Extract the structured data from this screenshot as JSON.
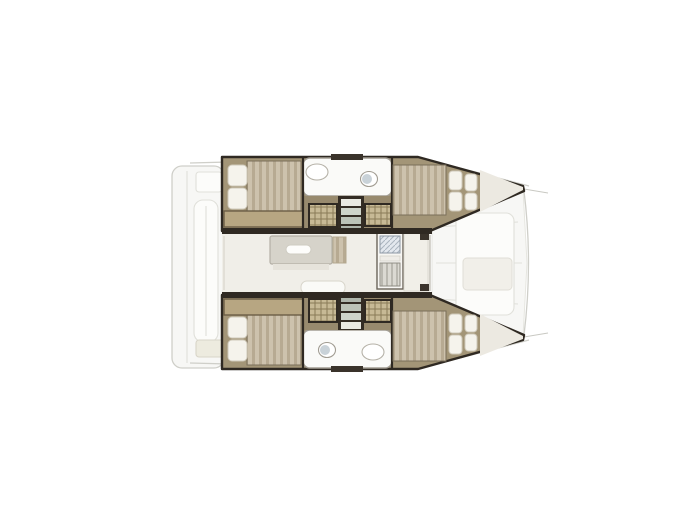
{
  "page": {
    "background": "#ffffff"
  },
  "colors": {
    "bg": "#ffffff",
    "outline": "#2f2922",
    "wood": "#a39577",
    "wood_dark": "#988a6e",
    "mattress": "#cdc2ad",
    "mattress_stripe": "#b7aa92",
    "mattress_edge": "#7a6e59",
    "pillow": "#f5f3ec",
    "pillow_edge": "#cfc9ba",
    "bench": "#b7a682",
    "bench_edge": "#6b5e46",
    "closet": "#c7b995",
    "closet_line": "#8a7a58",
    "bath": "#fafaf8",
    "bath_wall": "#a29d93",
    "toilet_seat": "#c9d2d8",
    "saloon": "#f0eee8",
    "table": "#d6d3ca",
    "table_edge": "#b3afa5",
    "galley": "#f7f6f3",
    "galley_edge": "#6b645a",
    "sink": "#e3e8ee",
    "sink_line": "#9aa6b2",
    "stove": "#dbd9d2",
    "stove_line": "#8e8b82",
    "ghost_fill": "#f7f7f5",
    "ghost_line": "#e0e0da",
    "ghost_line2": "#cfcfc9"
  },
  "plan": {
    "vessel": "catamaran",
    "view": "top-down interior floor plan, bow to the right",
    "port_hull": {
      "aft_cabin": "double-berth with two pillows",
      "head": "bathroom with sink and toilet",
      "companionway": "steps flanked by storage lockers",
      "forward_cabin": "double-berth with four pillows toward bow"
    },
    "starboard_hull": {
      "aft_cabin": "double-berth with two pillows",
      "head": "bathroom with toilet and sink",
      "companionway": "steps flanked by storage lockers",
      "forward_cabin": "double-berth with four pillows toward bow"
    },
    "saloon": [
      "dining-table",
      "seat-cushion",
      "galley-sink",
      "stove",
      "forward-seating"
    ],
    "exterior": [
      "stern-swim-platform",
      "aft-cockpit-bench",
      "foredeck-lounge",
      "bow-crossbeam"
    ]
  }
}
